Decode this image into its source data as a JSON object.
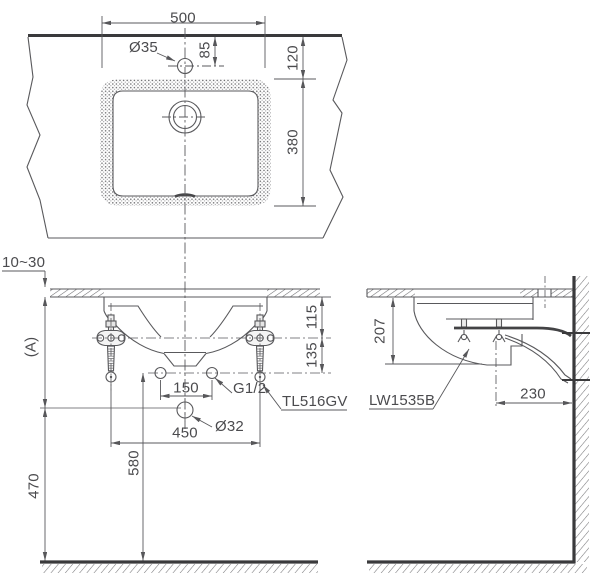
{
  "drawing": {
    "product": {
      "basin_model": "LW1535B",
      "hanger_model": "TL516GV",
      "supply_connection": "G1/2"
    },
    "colors": {
      "background": "#ffffff",
      "line": "#59595c",
      "dark_line": "#3a3a3c",
      "text": "#4b4b4e"
    },
    "top_view": {
      "overall_width": "500",
      "faucet_hole_diameter": "Ø35",
      "faucet_hole_offset": "85",
      "basin_front_offset": "120",
      "basin_depth": "380"
    },
    "front_view": {
      "counter_thickness": "10~30",
      "counter_height_label": "(A)",
      "hanger_drop": "115",
      "supply_drop": "135",
      "supply_spacing": "150",
      "supply_thread_label": "G1/2",
      "hanger_model_label": "TL516GV",
      "drain_diameter": "Ø32",
      "hanger_spacing": "450",
      "supply_height_from_floor": "580",
      "drain_height_from_floor": "470"
    },
    "side_view": {
      "basin_height": "207",
      "basin_model_label": "LW1535B",
      "drain_distance_from_wall": "230"
    }
  }
}
